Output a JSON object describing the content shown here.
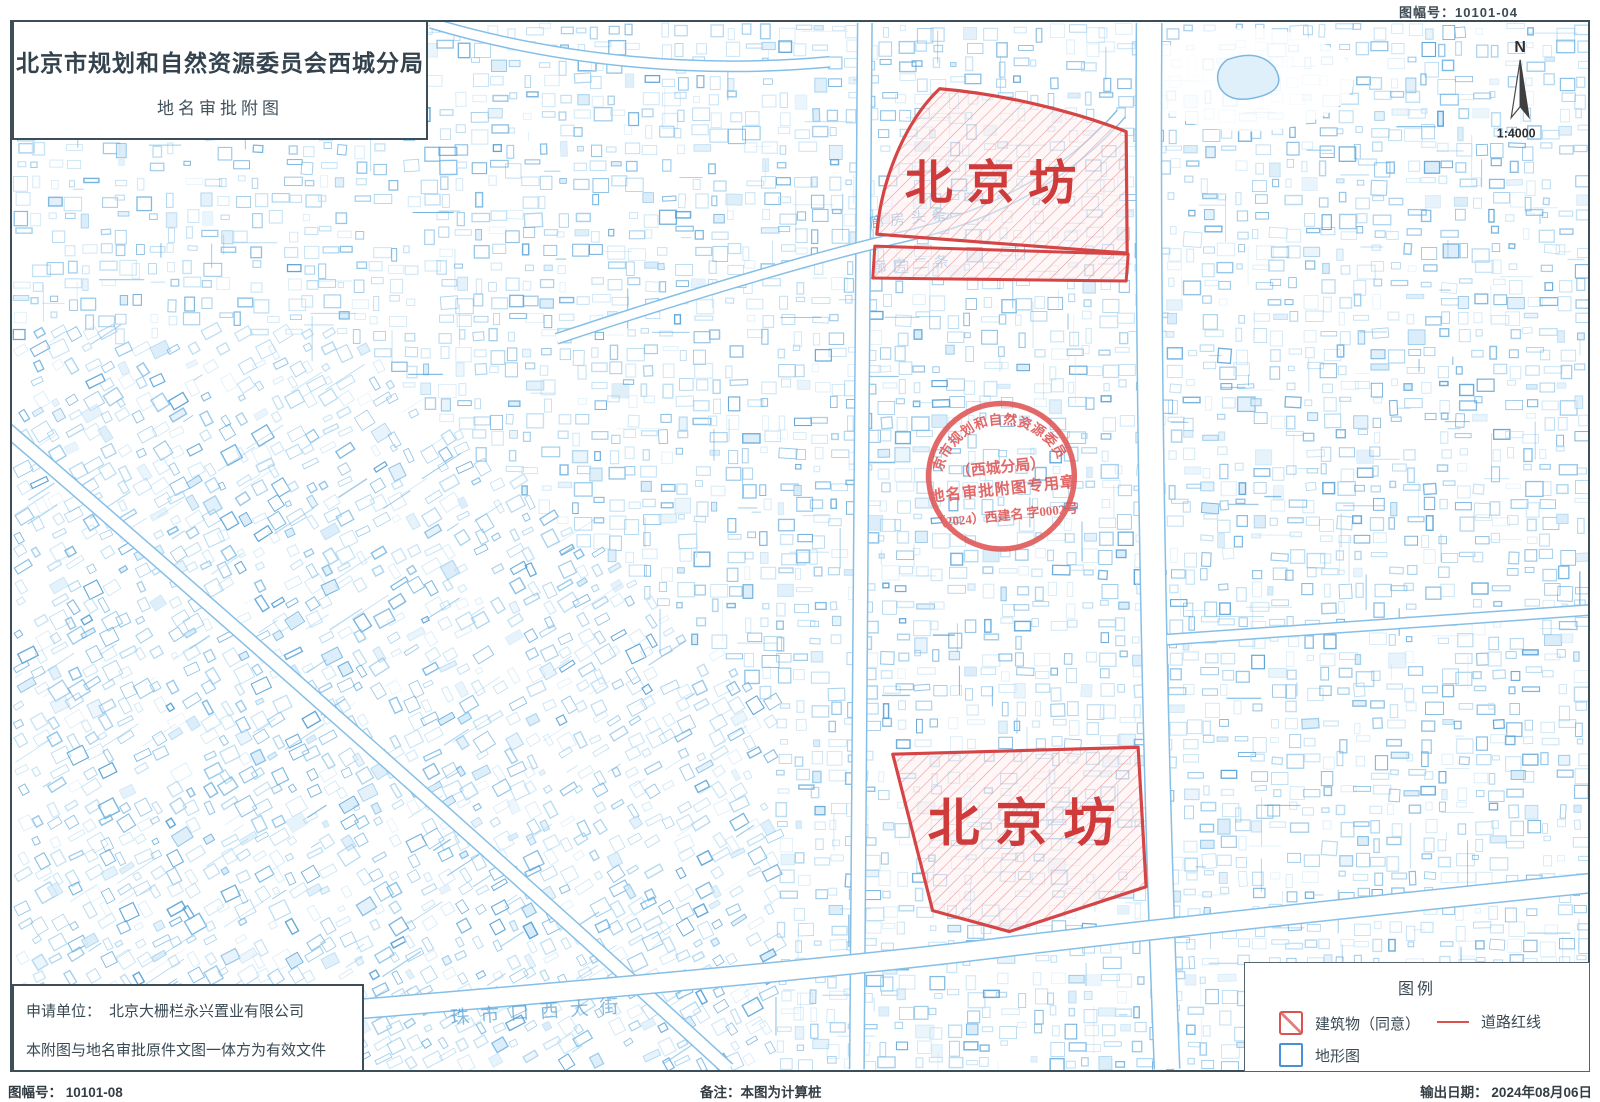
{
  "document": {
    "top_sheet_label": "图幅号：10101-04",
    "title": "北京市规划和自然资源委员会西城分局",
    "subtitle": "地名审批附图",
    "compass_n": "N",
    "scale": "1:4000"
  },
  "areas": {
    "top_label": "北京坊",
    "bottom_label": "北京坊"
  },
  "seal": {
    "ring_text": "北京市规划和自然资源委员会",
    "branch": "（西城分局）",
    "purpose": "地名审批附图专用章",
    "number": "（2024）西建名 字0002号"
  },
  "street_labels": [
    "廊房头条",
    "廊房二条",
    "珠市口西大街"
  ],
  "applicant": {
    "label": "申请单位：",
    "name": "北京大栅栏永兴置业有限公司",
    "validity_note": "本附图与地名审批原件文图一体方为有效文件"
  },
  "legend": {
    "title": "图例",
    "items": [
      {
        "swatch": "building-approved",
        "label": "建筑物（同意）"
      },
      {
        "swatch": "road-redline",
        "label": "道路红线"
      },
      {
        "swatch": "topographic",
        "label": "地形图"
      }
    ]
  },
  "footer": {
    "sheet_no": "图幅号： 10101-08",
    "remark": "备注：本图为计算桩",
    "output_date": "输出日期： 2024年08月06日"
  },
  "colors": {
    "accent_red": "#d9534f",
    "map_blue": "#5aa1d8",
    "ink": "#37474f"
  }
}
